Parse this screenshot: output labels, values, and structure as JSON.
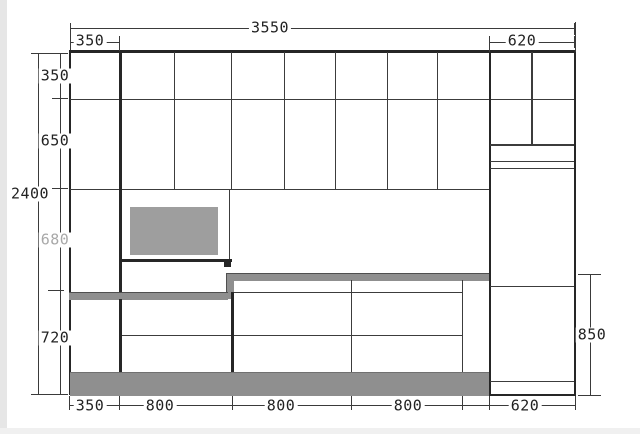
{
  "drawing": {
    "kind": "kitchen-cabinet-elevation",
    "colors": {
      "line": "#262626",
      "dim_line": "#3a3a3a",
      "dim_text": "#222222",
      "dim_text_muted": "#a8a8a8",
      "counter_fill": "#8f8f8f",
      "toe_kick_fill": "#8f8f8f",
      "hood_fill": "#9e9e9e",
      "background": "#ffffff"
    },
    "dims": {
      "top_total": "3550",
      "top_left": "350",
      "top_right": "620",
      "left_total": "2400",
      "left_seg1": "350",
      "left_seg2": "650",
      "left_seg3": "680",
      "left_seg4": "720",
      "right_counter": "850",
      "bottom_seg1": "350",
      "bottom_seg2": "800",
      "bottom_seg3": "800",
      "bottom_seg4": "800",
      "bottom_seg5": "620"
    }
  }
}
